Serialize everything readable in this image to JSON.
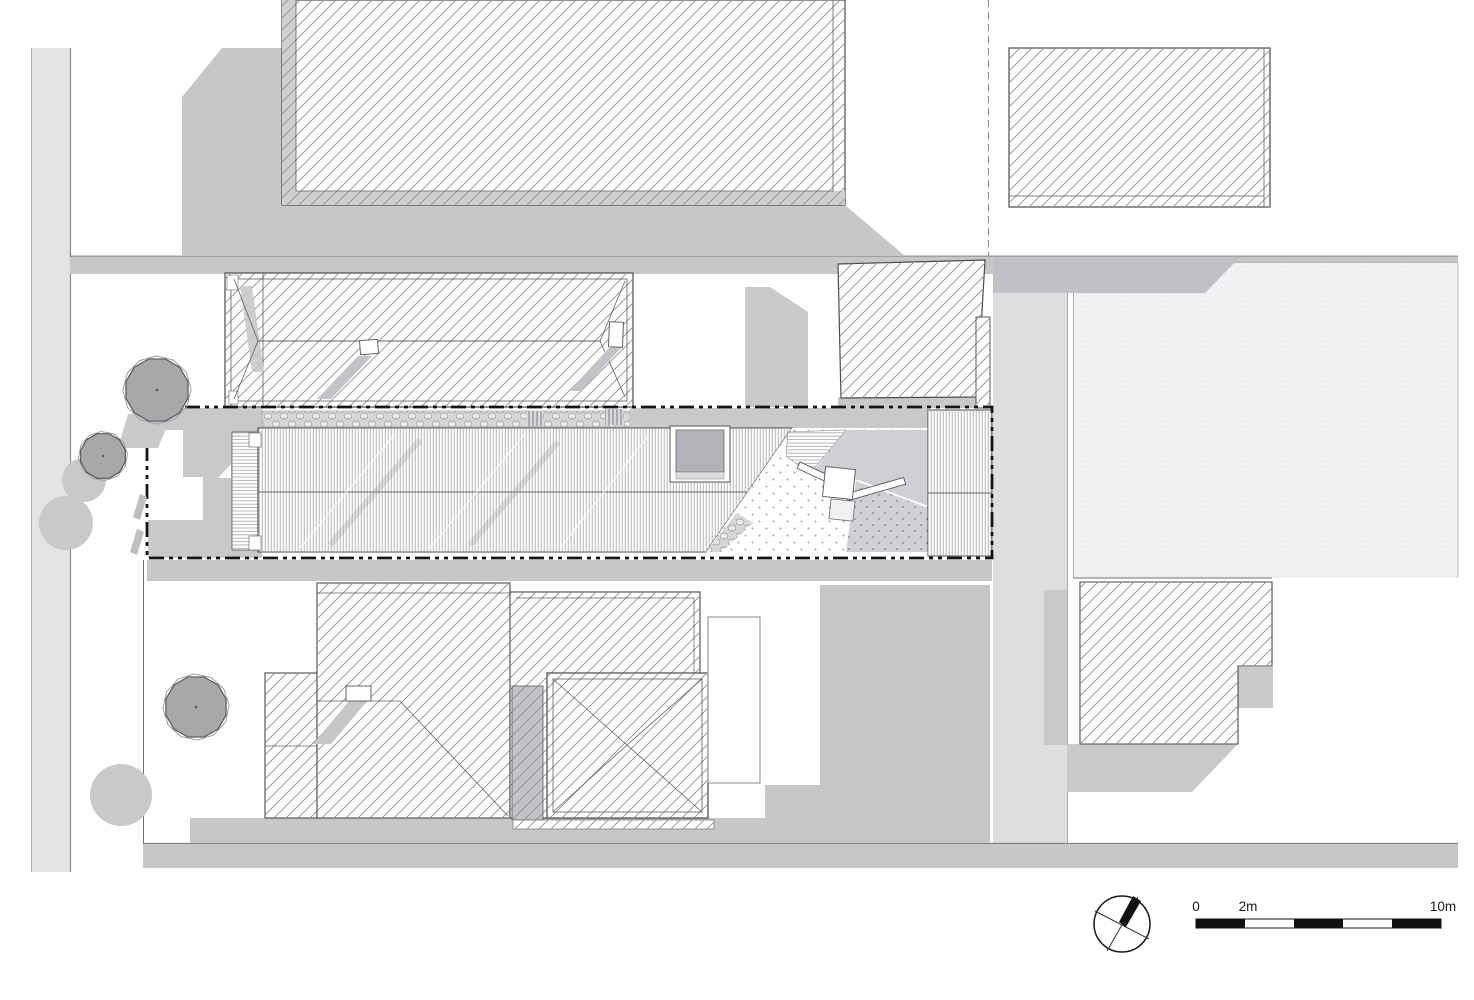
{
  "drawing": {
    "kind": "architectural-site-plan",
    "visible_text": [
      "0",
      "2m",
      "10m"
    ]
  },
  "scale_bar": {
    "labels": [
      "0",
      "2m",
      "10m"
    ],
    "total_meters": 10,
    "segment_count": 5,
    "filled_segment_indices": [
      0,
      2,
      4
    ]
  },
  "north_arrow": {
    "present": true,
    "style": "circle-with-crossed-lines-and-solid-needle",
    "needle_azimuth_deg": 25
  },
  "palette": {
    "background": "#ffffff",
    "shadow": "#c7c7ca",
    "shadow_dark": "#c1c1c5",
    "paving_light": "#e4e4e6",
    "driveway": "#dedee1",
    "field": "#f1f1f3",
    "yard_gray": "#c9c9cc",
    "tree_fill": "#a8a8ab",
    "hatch_line": "#8f8f93",
    "outline": "#45454a",
    "boundary_line": "#141414"
  },
  "areas": [
    "street-verge-west",
    "road-north",
    "road-south",
    "driveway-east",
    "field-east",
    "north-block-building",
    "northeast-building",
    "neighbor-house-north",
    "entrance-building",
    "subject-house",
    "skylight",
    "courtyard",
    "west-deck",
    "garden-strip",
    "site-boundary",
    "south-lot",
    "neighbor-house-south",
    "pavilion-roof",
    "terrace",
    "southeast-building",
    "trees"
  ]
}
